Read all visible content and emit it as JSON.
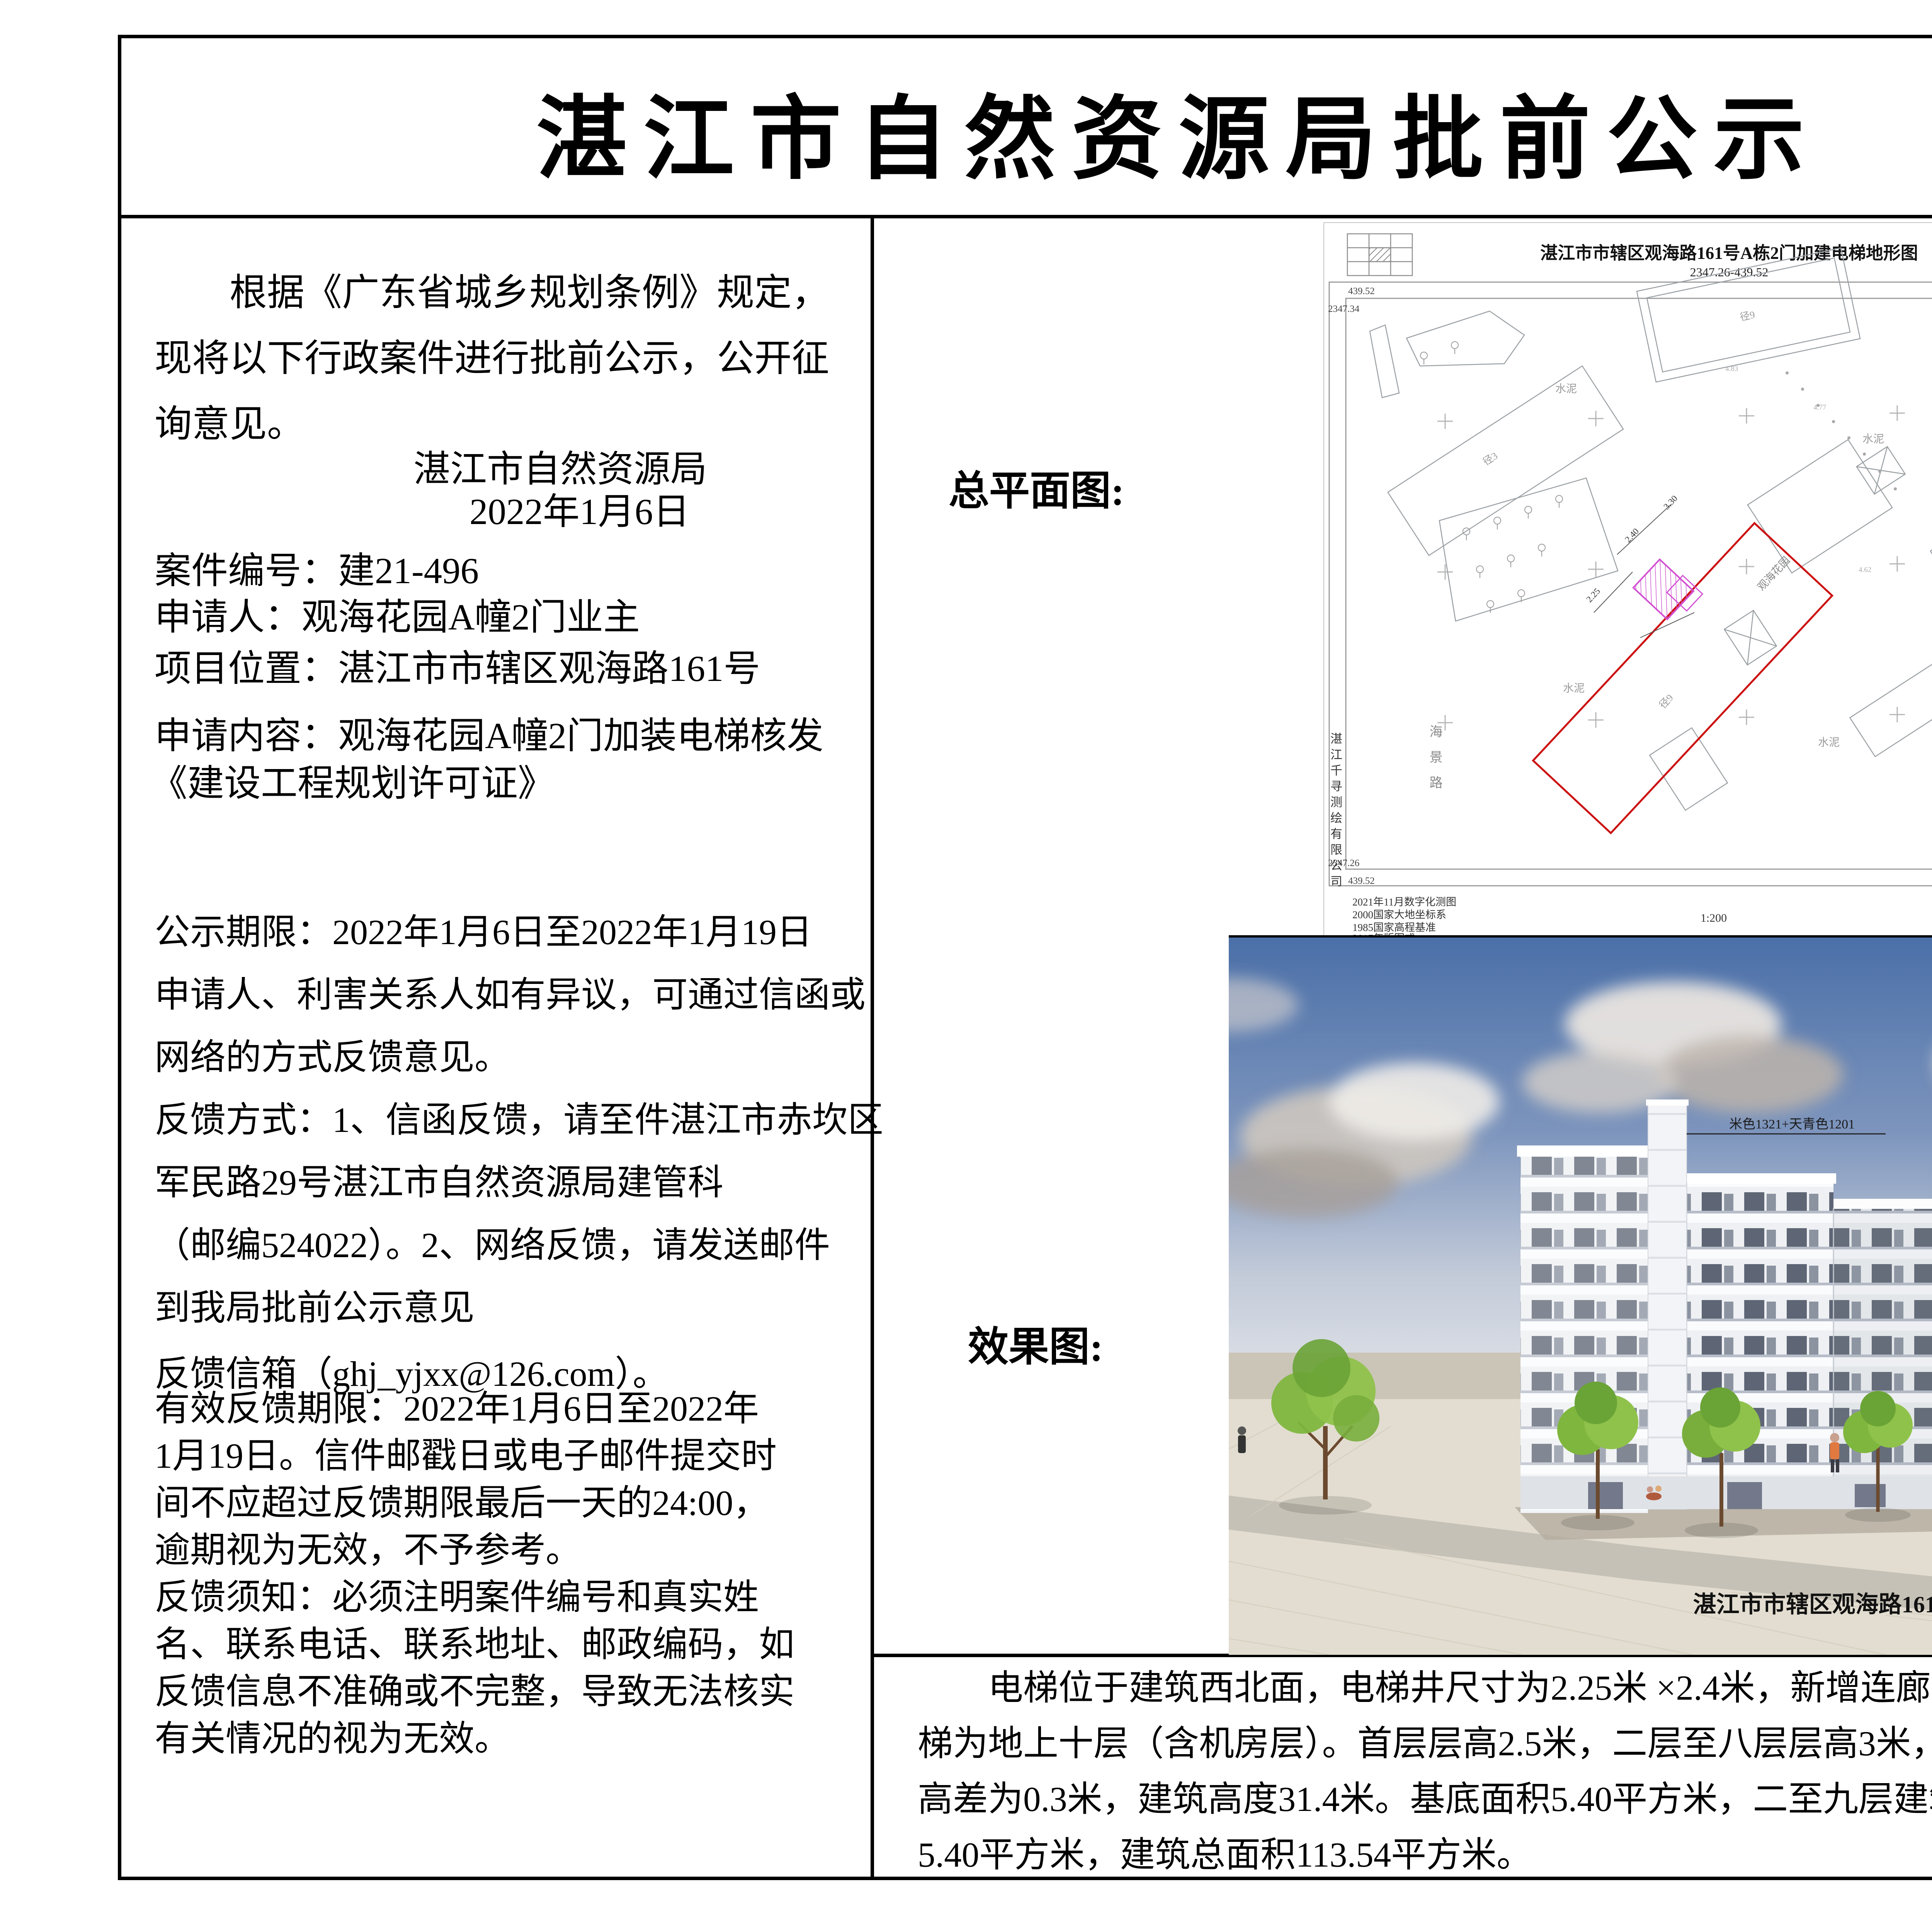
{
  "page": {
    "title": "湛江市自然资源局批前公示"
  },
  "notice": {
    "intro": [
      "　　根据《广东省城乡规划条例》规定，",
      "现将以下行政案件进行批前公示，公开征",
      "询意见。"
    ],
    "org": "湛江市自然资源局",
    "date": "2022年1月6日",
    "case_no": "案件编号：建21-496",
    "applicant": "申请人：观海花园A幢2门业主",
    "location": "项目位置：湛江市市辖区观海路161号",
    "content_1": "申请内容：观海花园A幢2门加装电梯核发",
    "content_2": "《建设工程规划许可证》",
    "period": [
      "公示期限：2022年1月6日至2022年1月19日",
      "申请人、利害关系人如有异议，可通过信函或",
      "网络的方式反馈意见。",
      "反馈方式：1、信函反馈，请至件湛江市赤坎区",
      "军民路29号湛江市自然资源局建管科",
      "（邮编524022）。2、网络反馈，请发送邮件",
      "到我局批前公示意见"
    ],
    "email": "反馈信箱（ghj_yjxx@126.com）。",
    "validity": [
      "有效反馈期限：2022年1月6日至2022年",
      "1月19日。信件邮戳日或电子邮件提交时",
      "间不应超过反馈期限最后一天的24:00，",
      "逾期视为无效，不予参考。",
      "反馈须知：必须注明案件编号和真实姓",
      "名、联系电话、联系地址、邮政编码，如",
      "反馈信息不准确或不完整，导致无法核实",
      "有关情况的视为无效。"
    ]
  },
  "siteplan": {
    "section_label": "总平面图:",
    "title": "湛江市市辖区观海路161号A栋2门加建电梯地形图",
    "subtitle": "2347.26-439.52",
    "corners": {
      "tl_a": "439.52",
      "tl_b": "2347.34",
      "tr_a": "439.52",
      "tr_b": "2347.34",
      "bl_a": "2347.26",
      "bl_b": "439.52",
      "br_a": "2347.26",
      "br_b": "439.52"
    },
    "company": "湛江千寻测绘有限公司",
    "road": "海景路",
    "garden": "观海花园",
    "cement": "水泥",
    "tile": "地砖",
    "bldg_a": "径3",
    "bldg_b": "径9",
    "dims": {
      "d1": "2.25",
      "d2": "2.40",
      "d3": "3.30"
    },
    "spots": {
      "s1": "4.83",
      "s2": "4.77",
      "s3": "4.80",
      "s4": "4.62"
    },
    "notes": [
      "2021年11月数字化测图",
      "2000国家大地坐标系",
      "1985国家高程基准",
      "2017年版图式"
    ],
    "scale": "1:200",
    "staff": [
      "测量员：张升",
      "绘图员：李超",
      "检查员："
    ]
  },
  "render": {
    "section_label": "效果图:",
    "annotation": "米色1321+天青色1201",
    "caption": "湛江市市辖区观海路161号观海花园A栋2门加建电梯"
  },
  "description": {
    "lines": [
      "　　电梯位于建筑西北面，电梯井尺寸为2.25米 ×2.4米，新增连廊进深1.5米（局部2.10米），长5.6米。电",
      "梯为地上十层（含机房层）。首层层高2.5米，二层至八层层高3米，九层4.5米，机房层层高3.1米，室内外地台",
      "高差为0.3米，建筑高度31.4米。基底面积5.40平方米，二至九层建筑面积均为12.84平方米，机房层建筑面积",
      "5.40平方米，建筑总面积113.54平方米。"
    ]
  }
}
